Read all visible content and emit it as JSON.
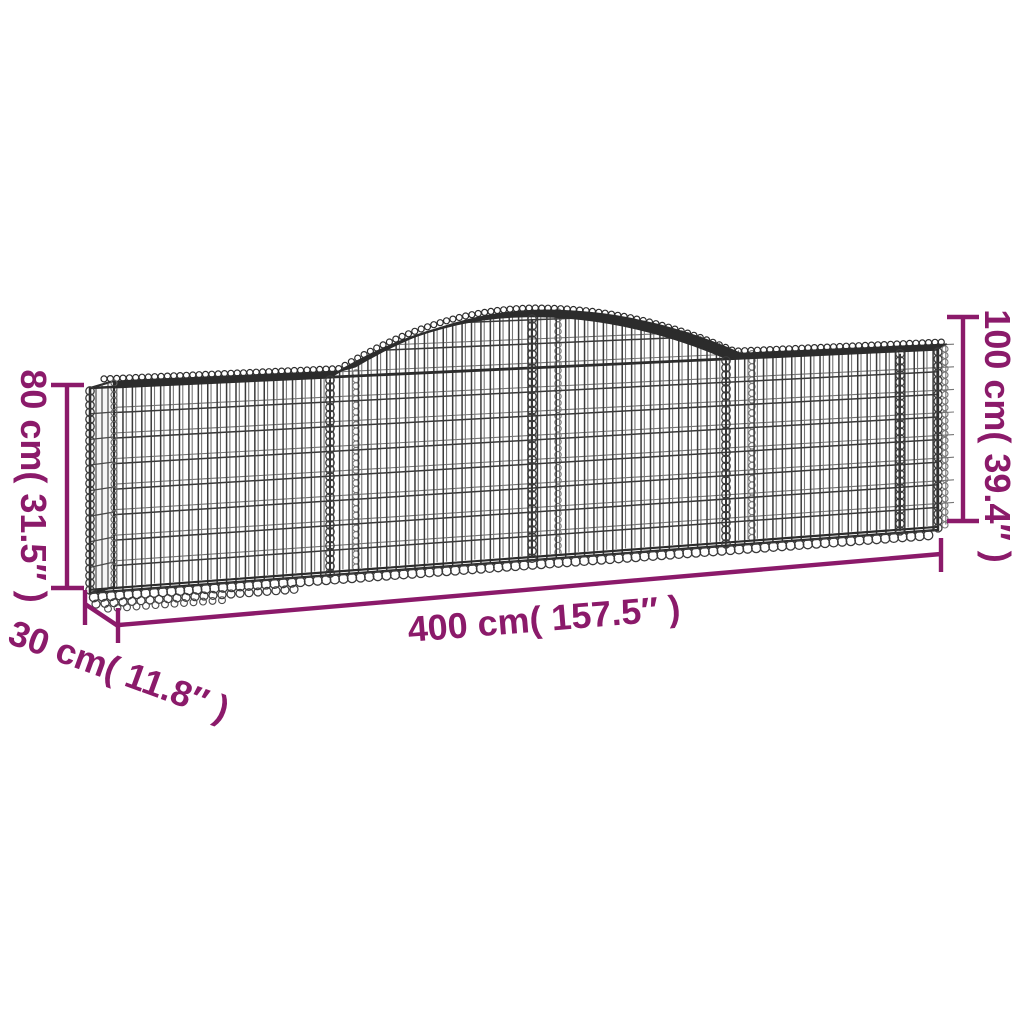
{
  "diagram": {
    "type": "product-dimension-diagram",
    "subject": "arched gabion wire mesh basket",
    "background": "#ffffff",
    "wire_color": "#3a3a3a",
    "wire_color_light": "#767676",
    "frame_color": "#2c2c2c"
  },
  "annotations": {
    "color": "#8b1a6a",
    "height_left": {
      "label": "80 cm( 31.5″ )",
      "value_cm": 80,
      "value_in": 31.5
    },
    "height_right": {
      "label": "100 cm( 39.4″ )",
      "value_cm": 100,
      "value_in": 39.4
    },
    "width_bottom": {
      "label": "400 cm( 157.5″ )",
      "value_cm": 400,
      "value_in": 157.5
    },
    "depth": {
      "label": "30 cm( 11.8″ )",
      "value_cm": 30,
      "value_in": 11.8
    }
  }
}
